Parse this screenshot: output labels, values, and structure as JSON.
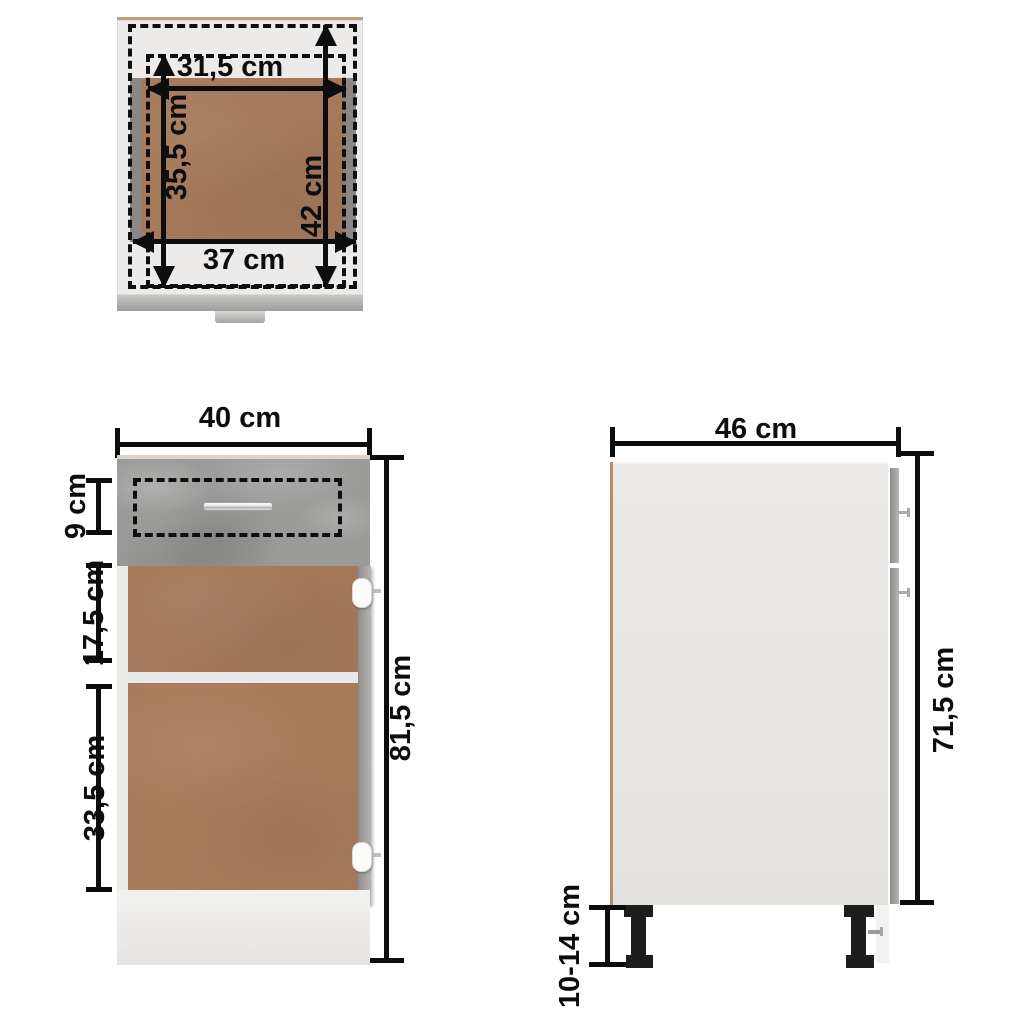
{
  "views": {
    "top": {
      "labels": {
        "inner_width": "31,5 cm",
        "inner_depth": "35,5 cm",
        "outer_depth": "42 cm",
        "outer_width": "37 cm"
      }
    },
    "front": {
      "labels": {
        "width": "40 cm",
        "drawer_front_height": "9 cm",
        "upper_section_height": "17,5 cm",
        "lower_section_height": "33,5 cm",
        "total_height": "81,5 cm"
      }
    },
    "side": {
      "labels": {
        "depth": "46 cm",
        "body_height": "71,5 cm",
        "leg_height": "10-14 cm"
      }
    }
  },
  "colors": {
    "dimension_ink": "#0d0d0d",
    "hdf_brown": "#a87c5b",
    "concrete_gray": "#9b9b99",
    "body_light_gray": "#e9e7e4",
    "plinth_white": "#efedeb",
    "leg_black": "#1d1d1b"
  }
}
